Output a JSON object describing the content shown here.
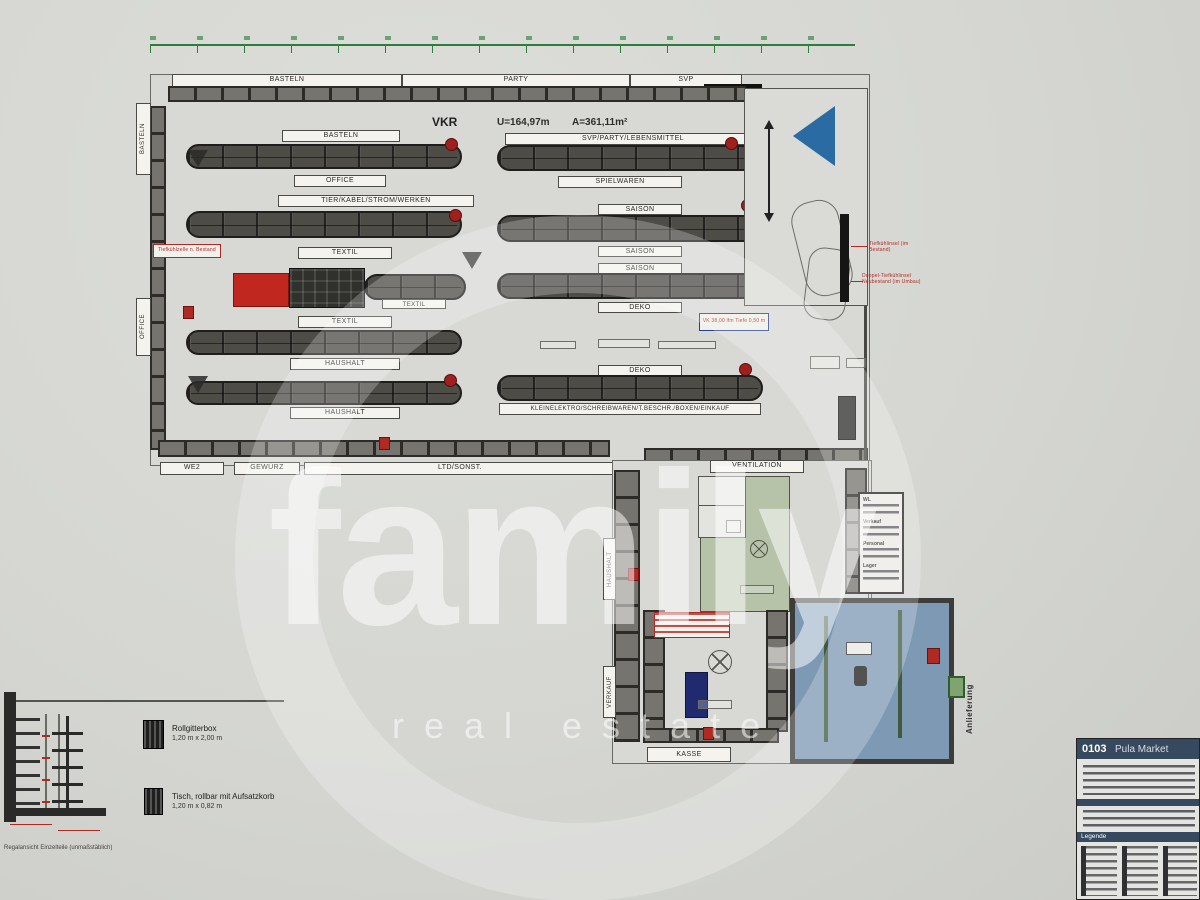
{
  "watermark": {
    "line1": "family",
    "line2": "real estate"
  },
  "plan": {
    "vkr": "VKR",
    "u_value": "U=164,97m",
    "a_value": "A=361,11m²",
    "top_sections": [
      "BASTELN",
      "PARTY",
      "SVP"
    ],
    "side_labels": [
      "BASTELN",
      "OFFICE"
    ],
    "left_aisles": [
      "BASTELN",
      "OFFICE",
      "TIER/KABEL/STROM/WERKEN",
      "TEXTIL",
      "TEXTIL",
      "TEXTIL",
      "HAUSHALT",
      "HAUSHALT"
    ],
    "right_aisles": [
      "SVP/PARTY/LEBENSMITTEL",
      "SPIELWAREN",
      "SAISON",
      "SAISON",
      "SAISON",
      "DEKO",
      "DEKO",
      "KLEINELEKTRO/SCHREIBWAREN/T.BESCHR./BOXEN/EINKAUF"
    ],
    "bottom_sections": [
      "WE2",
      "GEWÜRZ",
      "LTD/SONST."
    ],
    "annotations": {
      "left_red": "Tiefkühlzelle n. Bestand ±0,00",
      "right_red_1": "Tiefkühlinsel (im Bestand)",
      "right_red_2": "Doppel-Tiefkühlinsel Neubestand (im Umbau)",
      "deko_box": "VK 38,00 lfm Tiefe 0,50 m"
    }
  },
  "lower": {
    "ventilation": "VENTILATION",
    "vertical_label_1": "HAUSHALT",
    "vertical_label_2": "VERKAUF",
    "kasse": "KASSE",
    "anlieferung": "Anlieferung",
    "info_rows": [
      "WL",
      "Verkauf",
      "Personal",
      "Lager"
    ]
  },
  "legend": {
    "items": [
      {
        "title": "Rollgitterbox",
        "size": "1,20 m x 2,00 m"
      },
      {
        "title": "Tisch, rollbar mit Aufsatzkorb",
        "size": "1,20 m x 0,82 m"
      }
    ]
  },
  "elevation": {
    "caption": "Regalansicht Einzelteile (unmaßstäblich)"
  },
  "title_block": {
    "code": "0103",
    "name": "Pula Market",
    "legend_header": "Legende"
  }
}
